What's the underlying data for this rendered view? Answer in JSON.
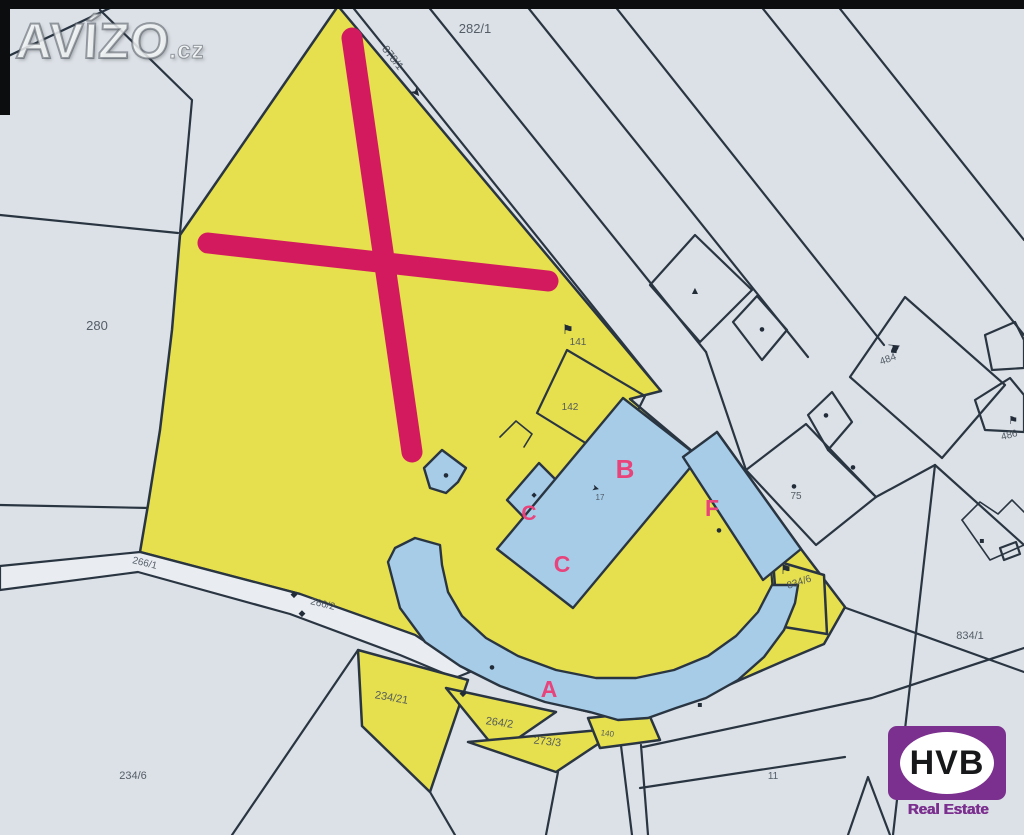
{
  "branding": {
    "watermark": {
      "name": "AVÍZO",
      "tld": ".cz"
    },
    "agency": {
      "name": "HVB",
      "subtitle": "Real Estate"
    }
  },
  "colors": {
    "paper": "#dce1e7",
    "parcel_yellow": "#e6df4e",
    "building_blue": "#a6cce8",
    "line_dark": "#2a3542",
    "cross_red": "#d41a5f",
    "letter_pink": "#e8437a",
    "label_gray": "#49525c",
    "brand_purple": "#7b2f8e"
  },
  "map": {
    "parcel_labels": [
      {
        "text": "282/1",
        "x": 475,
        "y": 33,
        "size": 13,
        "rotate": 0
      },
      {
        "text": "878/1",
        "x": 390,
        "y": 60,
        "size": 11,
        "rotate": 52
      },
      {
        "text": "280",
        "x": 97,
        "y": 330,
        "size": 13,
        "rotate": 0
      },
      {
        "text": "141",
        "x": 578,
        "y": 345,
        "size": 10,
        "rotate": 0
      },
      {
        "text": "142",
        "x": 570,
        "y": 410,
        "size": 10,
        "rotate": 0
      },
      {
        "text": "484",
        "x": 889,
        "y": 362,
        "size": 10,
        "rotate": -20
      },
      {
        "text": "486",
        "x": 1010,
        "y": 438,
        "size": 10,
        "rotate": -15
      },
      {
        "text": "75",
        "x": 796,
        "y": 499,
        "size": 10,
        "rotate": 0
      },
      {
        "text": "834/6",
        "x": 800,
        "y": 585,
        "size": 10,
        "rotate": -18
      },
      {
        "text": "834/1",
        "x": 970,
        "y": 639,
        "size": 11,
        "rotate": 0
      },
      {
        "text": "266/1",
        "x": 144,
        "y": 566,
        "size": 10,
        "rotate": 14
      },
      {
        "text": "266/2",
        "x": 322,
        "y": 607,
        "size": 10,
        "rotate": 14
      },
      {
        "text": "234/21",
        "x": 391,
        "y": 701,
        "size": 11,
        "rotate": 10
      },
      {
        "text": "264/2",
        "x": 499,
        "y": 726,
        "size": 11,
        "rotate": 8
      },
      {
        "text": "273/3",
        "x": 547,
        "y": 745,
        "size": 11,
        "rotate": 6
      },
      {
        "text": "140",
        "x": 607,
        "y": 736,
        "size": 8,
        "rotate": 8
      },
      {
        "text": "234/6",
        "x": 133,
        "y": 779,
        "size": 11,
        "rotate": 0
      },
      {
        "text": "11",
        "x": 773,
        "y": 779,
        "size": 10,
        "rotate": 0
      },
      {
        "text": "17",
        "x": 600,
        "y": 500,
        "size": 8,
        "rotate": 0
      }
    ],
    "building_letters": [
      {
        "text": "B",
        "x": 625,
        "y": 478,
        "size": 26
      },
      {
        "text": "C",
        "x": 529,
        "y": 520,
        "size": 21
      },
      {
        "text": "C",
        "x": 562,
        "y": 572,
        "size": 23
      },
      {
        "text": "F",
        "x": 712,
        "y": 516,
        "size": 23
      },
      {
        "text": "A",
        "x": 549,
        "y": 697,
        "size": 23
      }
    ],
    "symbols": [
      {
        "name": "flag-symbol",
        "glyph": "⚑",
        "x": 568,
        "y": 334,
        "size": 13,
        "rotate": 0
      },
      {
        "name": "flag-symbol",
        "glyph": "⚑",
        "x": 786,
        "y": 574,
        "size": 13,
        "rotate": 0
      },
      {
        "name": "flag-symbol",
        "glyph": "⚑",
        "x": 888,
        "y": 348,
        "size": 15,
        "rotate": 96
      },
      {
        "name": "flag-symbol",
        "glyph": "⚑",
        "x": 1013,
        "y": 424,
        "size": 11,
        "rotate": 0
      },
      {
        "name": "road-arrow",
        "glyph": "➤",
        "x": 413,
        "y": 95,
        "size": 13,
        "rotate": 50
      },
      {
        "name": "survey-dot",
        "glyph": "●",
        "x": 794,
        "y": 488,
        "size": 6,
        "rotate": 0
      },
      {
        "name": "survey-dot",
        "glyph": "●",
        "x": 853,
        "y": 469,
        "size": 6,
        "rotate": 0
      },
      {
        "name": "survey-dot",
        "glyph": "●",
        "x": 762,
        "y": 331,
        "size": 6,
        "rotate": 0
      },
      {
        "name": "survey-dot",
        "glyph": "●",
        "x": 826,
        "y": 417,
        "size": 6,
        "rotate": 0
      },
      {
        "name": "survey-dot",
        "glyph": "●",
        "x": 492,
        "y": 669,
        "size": 6,
        "rotate": 0
      },
      {
        "name": "survey-dot",
        "glyph": "●",
        "x": 719,
        "y": 532,
        "size": 6,
        "rotate": 0
      },
      {
        "name": "survey-dot",
        "glyph": "●",
        "x": 446,
        "y": 477,
        "size": 6,
        "rotate": 0
      },
      {
        "name": "triangle-mark",
        "glyph": "▲",
        "x": 695,
        "y": 293,
        "size": 8,
        "rotate": 0
      },
      {
        "name": "boundary-diamond",
        "glyph": "◆",
        "x": 294,
        "y": 597,
        "size": 9,
        "rotate": 0
      },
      {
        "name": "boundary-diamond",
        "glyph": "◆",
        "x": 302,
        "y": 616,
        "size": 9,
        "rotate": 0
      },
      {
        "name": "boundary-diamond",
        "glyph": "◆",
        "x": 463,
        "y": 696,
        "size": 9,
        "rotate": 0
      },
      {
        "name": "boundary-diamond",
        "glyph": "◆",
        "x": 534,
        "y": 497,
        "size": 7,
        "rotate": 0
      },
      {
        "name": "arrow-mark",
        "glyph": "➤",
        "x": 595,
        "y": 491,
        "size": 9,
        "rotate": 15
      },
      {
        "name": "square-dot",
        "glyph": "▪",
        "x": 700,
        "y": 707,
        "size": 8,
        "rotate": 0
      },
      {
        "name": "square-dot",
        "glyph": "▪",
        "x": 982,
        "y": 543,
        "size": 8,
        "rotate": 0
      }
    ]
  }
}
